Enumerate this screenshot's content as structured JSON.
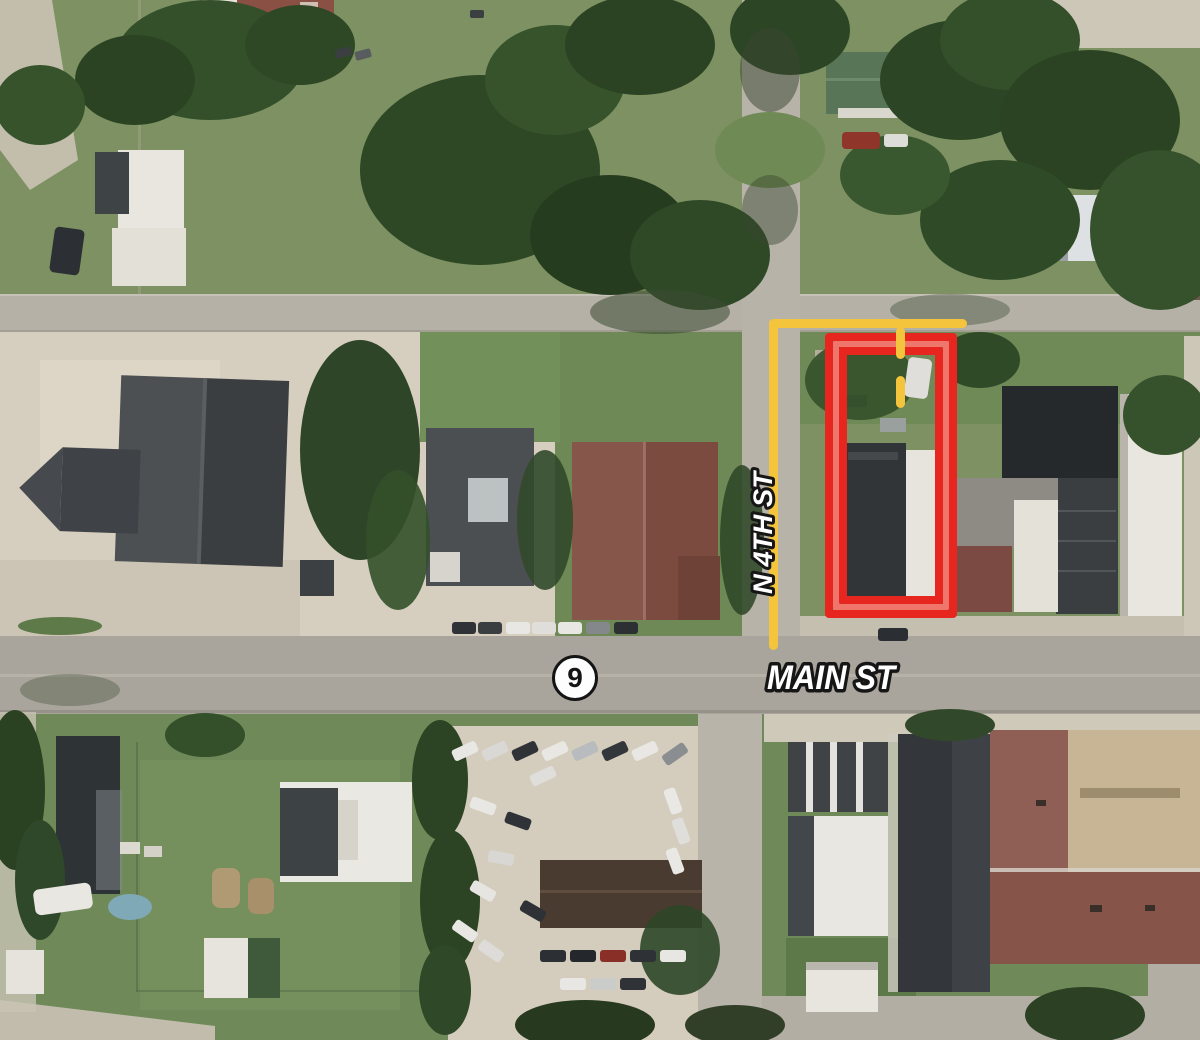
{
  "map": {
    "streets": {
      "vertical_label": "N 4TH ST",
      "horizontal_label": "MAIN ST"
    },
    "route_badge": {
      "number": "9"
    },
    "annotations": {
      "highlight_color": "#E82620",
      "highlight_inner_color": "#F0766C",
      "route_line_color": "#F4C43C",
      "label_fill": "#FFFFFF",
      "label_outline": "#161616"
    }
  }
}
